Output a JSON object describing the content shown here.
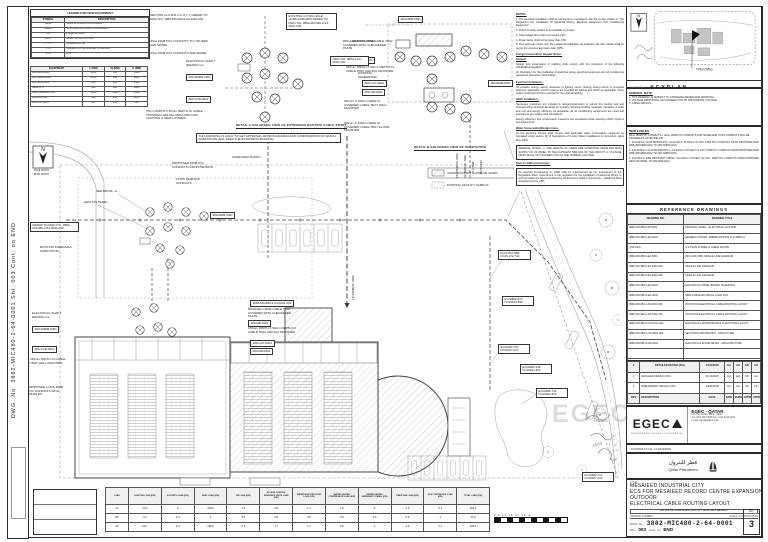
{
  "frame": {
    "left_strip": "DWG. No. 3882-MIC480-2-64-0001      Sht. 003      Cont. on END"
  },
  "legend": {
    "title": "LEGEND FOR NEW EQUIPMENT",
    "rows": [
      [
        "SYMBOL",
        "DESCRIPTION"
      ],
      [
        "MDB",
        "MAIN DISTRIBUTION BOARD"
      ],
      [
        "SMDB",
        "SUB MAIN DISTRIBUTION BOARD"
      ],
      [
        "PB",
        "PANEL BOARD"
      ],
      [
        "ECO",
        "ELECTRICAL CUT-OUT"
      ],
      [
        "— — —",
        "CABLE ROUTE"
      ],
      [
        "CTC",
        "CABLE ROUTE MARKER STRAIGHT"
      ],
      [
        "ATS",
        "ATS"
      ]
    ]
  },
  "equipment": {
    "rows": [
      [
        "EQUIPMENT",
        "L (MM)",
        "W (MM)",
        "H (MM)"
      ],
      [
        "480-MDB-0001",
        "1250",
        "600",
        "1900"
      ],
      [
        "480-SMDB-0001",
        "1250",
        "600",
        "1900"
      ],
      [
        "480-SDB-0001",
        "800",
        "600",
        "1900"
      ],
      [
        "NEW ATS",
        "800",
        "600",
        "1800"
      ],
      [
        "NEW GENERATOR",
        "3000",
        "1100",
        "1600"
      ],
      [
        "480-DB-0001",
        "600",
        "400",
        "1100"
      ],
      [
        "480-LCP-0001",
        "457",
        "305",
        "610"
      ]
    ]
  },
  "notes": {
    "items": [
      {
        "t": "NOTES:-",
        "u": 1
      },
      {
        "t": "1. The electrical installation shall be carried out in compliance with the current edition of “The Regulation For Installation Of Electrical Wiring, Electrical Equipment And Conditioning Equipment”."
      },
      {
        "t": "2. Drawn & cable window to be available by design."
      },
      {
        "t": "3. Total voltage drop shall not exceed 2.5%."
      },
      {
        "t": "4. Power factor shall not be lower than 0.90."
      },
      {
        "t": "5. This approval covers only the notations/modification as indicated. All other details shall be as per the previous approval under QPW.",
        "mb": 3
      },
      {
        "t": "Energy Conservation Regular Notes:-",
        "u": 1
      },
      {
        "t": "General:",
        "u": 1
      },
      {
        "t": "Design and construction of building shall comply with the provisions of the following KAHRAMAA regulation:"
      },
      {
        "t": "(1) Regulation for the installation of electrical wiring, electrical equipment and air conditioning equipment December 2010 edition.",
        "mb": 3
      },
      {
        "t": "Electrical Installation:-",
        "u": 1
      },
      {
        "t": "All possible energy saving measures in lighting sector. Energy saving lamps is proposed wherever applicable; control systems are provided for lighting and HVAC as applicable. Timer and/or photocell control is ensured for the external lighting.",
        "mb": 3
      },
      {
        "t": "HVAC Installation:-",
        "u": 1
      },
      {
        "t": "Necessary provisions are included in design/construction to reduce the cooling load and corresponding electrical demands by properly selecting building materials, insulation to walls and roof and energy efficiency as applicable. All air conditioning equipments are sized and selected as per cooling load calculations."
      },
      {
        "t": "Energy efficiency and conservation measures are considered while selecting HVAC systems and equipments.",
        "mb": 3
      },
      {
        "t": "Water Conservation/Design notes:-",
        "u": 1
      },
      {
        "t": "All the plumbing fixtures shall comply with applicable water conservation measures as stipulated under section (3) of Regulations of Interior Water installations & connection mains May 2005.",
        "mb": 3
      },
      {
        "t": "GENERAL NOTES:-  1- THE LENGTH OF CABLE ARE COMPUTED FROM THE MAIN SUPPLY OF CS PANEL TO THE FARTHEST DB/LOAD OF THE CIRCUIT.  2- VOLTAGE DROP SHALL NOT EXCEED 2.5% OF THE NOMINAL VOLTAGE.",
        "b": 1
      },
      {
        "t": "Note for AMR provisioning:-",
        "u": 1
      },
      {
        "t": "As required provisioning for AMR shall be implemented as per amendment to the Regulation titled “Amendment to the regulation for the installation of Electrical Wiring to accommodate the Advanced Metering Infrastructure (AMI) Components – Additional Field Requirements for AMI”.",
        "b": 1
      }
    ]
  },
  "plan": {
    "labels": [
      {
        "x": 150,
        "y": 14,
        "t": "SECTION (A-A,B-B,C-C & Y-Y) REFER TO DWG NO. 3882-MIC480-2-64-0001-002",
        "w": 62
      },
      {
        "x": 150,
        "y": 40,
        "t": "4Nos 150Ø PVC CONDUITS TO UTILIZED AND SPARE",
        "w": 62
      },
      {
        "x": 150,
        "y": 52,
        "t": "2Nos 150Ø PVC CONDUITS ARE SPARE",
        "w": 62
      },
      {
        "x": 286,
        "y": 13,
        "t": "EXISTING C.P.WH HOLE (1200x1200x600) REFER TO DWG NO. 3882-MIC480-2-64-0001-002",
        "w": 46,
        "b": 1
      },
      {
        "x": 186,
        "y": 60,
        "t": "ELECTRICAL SHAFT 900x600 mm",
        "w": 40
      },
      {
        "x": 186,
        "y": 74,
        "t": "480-SMDB-0001",
        "b": 1
      },
      {
        "x": 186,
        "y": 96,
        "t": "480-CCB-0002",
        "b": 1
      },
      {
        "x": 343,
        "y": 40,
        "t": "800mmX1350mm BCE CABLE TRAY COVERED WITH CHECKERED PLATE",
        "w": 52
      },
      {
        "x": 352,
        "y": 57,
        "t": "480-DB-0001",
        "b": 1
      },
      {
        "x": 346,
        "y": 66,
        "t": "150mm WIDTH X 50mm DEPTH GI CABLE TRAY CEILING MOUNTED",
        "w": 55
      },
      {
        "x": 362,
        "y": 80,
        "t": "480-LCP-0001",
        "b": 1
      },
      {
        "x": 362,
        "y": 89,
        "t": "480-DB-0002",
        "b": 1
      },
      {
        "x": 146,
        "y": 110,
        "t": "75mm WIDTH X 50mm DEPTH GI CABLE TRUNKING CEILING MOUNTED FOR LIGHTING & SMALL POWER",
        "w": 58
      },
      {
        "x": 398,
        "y": 16,
        "t": "480-MDB-0001",
        "b": 1
      },
      {
        "x": 366,
        "y": 24,
        "t": "EXISTING SUBSTATION",
        "light": 1
      },
      {
        "x": 352,
        "y": 40,
        "t": "NEW ATS PANEL"
      },
      {
        "x": 330,
        "y": 56,
        "t": "DWG NO. 3882-2-64-0001-002",
        "w": 34,
        "b": 1
      },
      {
        "x": 358,
        "y": 72,
        "t": "EXISTING GENERATOR",
        "w": 30
      },
      {
        "x": 344,
        "y": 100,
        "t": "300mm X 100mm WIDE GI COVERED CABLE TRAY WALL MOUNTED",
        "w": 46
      },
      {
        "x": 344,
        "y": 122,
        "t": "300mm X 100mm WIDE GI COVERED CABLE TRAY FLOOR MOUNTED",
        "w": 46
      },
      {
        "x": 488,
        "y": 80,
        "t": "480-EDB-0001",
        "b": 1
      },
      {
        "x": 414,
        "y": 146,
        "t": "DETAIL-B ENLARGED VIEW OF SUBSTATION",
        "u": 1
      },
      {
        "x": 236,
        "y": 124,
        "t": "DETAIL-A ENLARGED VIEW OF EXTENSION ROUTING CABLE ENTRY",
        "u": 1
      },
      {
        "x": 196,
        "y": 133,
        "t": "THIS DRAWING IS HOLD TO GET APPROVAL FROM KAHRAMAA AND CONFIRMATION OF WHICH SUBSTATION WILL FEED THE EXTENSION BUILDING",
        "w": 140,
        "b": 1
      },
      {
        "x": 232,
        "y": 156,
        "t": "KAHRAMAA SUPPLY"
      },
      {
        "x": 96,
        "y": 190,
        "t": "SEE DETAIL -A"
      },
      {
        "x": 84,
        "y": 201,
        "t": "NEW ATS PANEL"
      },
      {
        "x": 30,
        "y": 222,
        "t": "REFER TO DWG NO. 3882-MIC480-2-64-0001-002",
        "w": 44,
        "b": 1
      },
      {
        "x": 40,
        "y": 246,
        "t": "EXISTING KAHRAMAA SUBSTATION",
        "w": 36
      },
      {
        "x": 172,
        "y": 162,
        "t": "PROPOSED 100Ø PVC CONDUITS FOR EXTENSION",
        "w": 44
      },
      {
        "x": 176,
        "y": 178,
        "t": "2 NOS 100Ø PVC CONDUITS",
        "w": 34
      },
      {
        "x": 210,
        "y": 212,
        "t": "480-MDB-0001",
        "b": 1
      },
      {
        "x": 250,
        "y": 300,
        "t": "3882-MIC480-2-64-0001-002",
        "b": 1
      },
      {
        "x": 248,
        "y": 308,
        "t": "800x600mm BCE CABLE TRAY COVERED WITH CHECKERED PLATE",
        "w": 50
      },
      {
        "x": 248,
        "y": 320,
        "t": "480-DB-0001",
        "b": 1
      },
      {
        "x": 248,
        "y": 327,
        "t": "150mm WIDTH X 50mm DEPTH GI CABLE TRAY CEILING MOUNTED",
        "w": 52
      },
      {
        "x": 250,
        "y": 340,
        "t": "480-LCP-0001",
        "b": 1
      },
      {
        "x": 250,
        "y": 348,
        "t": "480-DB-0002",
        "b": 1
      },
      {
        "x": 32,
        "y": 312,
        "t": "ELECTRICAL SHAFT 900x600 mm",
        "w": 36
      },
      {
        "x": 32,
        "y": 326,
        "t": "480-SMDB-0001",
        "b": 1
      },
      {
        "x": 32,
        "y": 346,
        "t": "480-CCB-0001",
        "b": 1
      },
      {
        "x": 30,
        "y": 358,
        "t": "150mm WIDTH GI CABLE TRAY WALL MOUNTED",
        "w": 40
      },
      {
        "x": 28,
        "y": 386,
        "t": "PROPOSED 4 NOS 100Ø PVC CONDUITS WITH DRAW PIT",
        "w": 40
      },
      {
        "x": 524,
        "y": 176,
        "t": "E=23359.200 N=26190.820",
        "w": 27,
        "b": 1
      },
      {
        "x": 498,
        "y": 250,
        "t": "E=23,867.988 N=26,172.742",
        "w": 28,
        "b": 1
      },
      {
        "x": 502,
        "y": 296,
        "t": "E=22869.670 N=26216.830",
        "w": 27,
        "b": 1
      },
      {
        "x": 498,
        "y": 344,
        "t": "E=23283.767 N=26017.017",
        "w": 27,
        "b": 1
      },
      {
        "x": 520,
        "y": 364,
        "t": "E=23283.138 N=26231.822",
        "w": 27,
        "b": 1
      },
      {
        "x": 536,
        "y": 388,
        "t": "E=23286.731 N=26031.876",
        "w": 27,
        "b": 1
      },
      {
        "x": 582,
        "y": 472,
        "t": "E=23282.711 N=26007.074",
        "w": 27,
        "b": 1
      },
      {
        "x": 447,
        "y": 172,
        "t": "CONSTRUCTION SCOPE OF WORK"
      },
      {
        "x": 447,
        "y": 184,
        "t": "EXISTING FACILITY CAMPUS"
      },
      {
        "x": 456,
        "y": 178,
        "t": "15x185Ø(4C-70Ø)",
        "r": -90
      },
      {
        "x": 464,
        "y": 178,
        "t": "3x150Ø(4C-70Ø)",
        "r": -90
      },
      {
        "x": 472,
        "y": 172,
        "t": "1x150Ø",
        "r": -90
      },
      {
        "x": 480,
        "y": 174,
        "t": "EXISTING",
        "r": -90
      },
      {
        "x": 352,
        "y": 300,
        "t": "16x185Ø(4C-70Ø)",
        "r": -90
      },
      {
        "x": 34,
        "y": 170,
        "t": "TRUE NORTH",
        "fs": 2.3
      },
      {
        "x": 34,
        "y": 174,
        "t": "BLDG NORTH",
        "fs": 2.3
      },
      {
        "x": 592,
        "y": 444,
        "t": "18/12",
        "hw": 1,
        "fs": 4,
        "r": -15
      }
    ]
  },
  "keyplan": {
    "north": "N",
    "this_dwg": "THIS DWG",
    "caption": "KEYPLAN",
    "hw": "4/12/18"
  },
  "general_note": {
    "title": "GENERAL NOTE:",
    "items": [
      {
        "t": "1. THIS DRAWING IS SUBJECT TO KAHRAMAA REVIEW AND APPROVAL."
      },
      {
        "t": "2. VOLTAGE DROP SHALL NOT EXCEED 2.5% OF THE NOMINAL VOLTAGE."
      },
      {
        "t": "3. CABLE DETAILS:-"
      }
    ]
  },
  "new_cables": {
    "title": "NEW CABLES",
    "intro": "4Nos 150Ø PVC CONDUITS + 2Nos 150Ø PVC CONDUITS FOR SPARE AND THICK CONDUITS WILL BE UTILIZED AS LISTED BELOW",
    "items": [
      {
        "t": "1.  4Cx240mm² CU/XLPE/SWA/PVC +1Cx120mm² PVC/ECC IN 1NO. 150Ø PVC CONDUITS FROM PROPOSED NEW MDB (480-MDB-0001) TO (480-SMDB-0001)."
      },
      {
        "t": "2.  2(3Cx240mm² AL/XLPE/SWA/PVC) +1Cx240mm² PVC/ECC IN 2NO. 150Ø PVC CONDUITS FROM PROPOSED NEW MDB (480-MDB-0001) TO (480-SMDB-0002)."
      },
      {
        "t": "3.  4Cx240mm² FIRE RESISTANT CABLE +1Cx120mm² PVC/ECC IN 1NO. 150Ø PVC CONDUITS FROM PROPOSED NEW ATS PANEL TO (480-SDB-0001)."
      }
    ]
  },
  "reference_drawings": {
    "title": "REFERENCE DRAWINGS",
    "rows": [
      [
        "DRAWING NO.",
        "DRAWING TITLE"
      ],
      [
        "3882-MIC480-0-00-0001",
        "DRAWING INDEX - ELECTRICAL SYSTEM"
      ],
      [
        "3882-MIC480-0-EA-0001",
        "GENERAL NOTES, ABBREVIATIONS & SYMBOLS"
      ],
      [
        "(765-A00)",
        "S.S PLAN-POWER & CABLE ROUTE"
      ],
      [
        "3882-MIC480-9-EJ-0001",
        "(MIC-400)-0001 SINGLE LINE DIAGRAM"
      ],
      [
        "3882-MIC480-9-EJ-0002-001",
        "SINGLE LINE DIAGRAM"
      ],
      [
        "3882-MIC480-9-EJ-0002-002",
        "SINGLE LINE DIAGRAM"
      ],
      [
        "3882-MIC480-9-EA-0001",
        "ELECTRICAL PANEL BOARD SCHEDULE"
      ],
      [
        "3882-MIC480-9-EA-0002",
        "MDB-A DB ELECTRICAL LOAD LIST"
      ],
      [
        "3882-MIC480-2-64-0001-001",
        "OUTDOOR ELECTRICAL CABLE ROUTING LAYOUT"
      ],
      [
        "3882-MIC480-2-64-0001-002",
        "OUTDOOR ELECTRICAL CABLE ROUTING LAYOUT"
      ],
      [
        "3882-MIC480-9-CD-0012-002",
        "ELECTRICAL ROOM DETAILS & SECTIONS LAYOUT"
      ],
      [
        "3882-MIC480-9-CP-0001-004",
        "SECTIONS AND DETAILS - STRUCTURE"
      ],
      [
        "3882-MIC480-9-AD-0001",
        "ELECTRICAL ROOM DETAIL - ARCHITECTURE"
      ],
      [
        "",
        ""
      ],
      [
        "",
        ""
      ],
      [
        "",
        ""
      ]
    ]
  },
  "revisions": {
    "rows": [
      [
        "2",
        "DETAILED DESIGN (IFA)",
        "17/12/2018",
        "AH",
        "AH",
        "KN",
        "AH"
      ],
      [
        "1",
        "DETAILED DESIGN (IFC)",
        "01/11/2018",
        "AH",
        "AH",
        "KN",
        "AH"
      ],
      [
        "0",
        "PRELIMINARY DESIGN (IFC)",
        "24/09/2018",
        "AH",
        "AH",
        "KN",
        "LD"
      ],
      [
        "REV",
        "DESCRIPTION",
        "DATE",
        "DRN",
        "CHKD",
        "APPD",
        "APPD"
      ]
    ]
  },
  "logos": {
    "watermark": "EGEC",
    "consultant": "EGEC",
    "consultant_sub": "ENGINEERING HOUSE OF EXPERTISE",
    "qatar": "EGEC - QATAR",
    "addr1": "P.O. Box 24149, Doha - Qatar",
    "addr2": "Tel: +974 4443 6666  Fax: +974 4443 2181",
    "addr3": "e-mail: egec@qatar.net.qa",
    "contract": "CONTRACT No. LC19194900"
  },
  "client": {
    "arabic": "قطر للبترول",
    "english": "Qatar Petroleum"
  },
  "title_block": {
    "label": "TITLE",
    "line1": "MESAIEED INDUSTRIAL CITY",
    "line2": "ECS FOR MESAIEED RECORD CENTRE EXPANSION",
    "line3": "OUTDOOR",
    "line4": "ELECTRICAL CABLE ROUTING LAYOUT",
    "cad_note": "THIS IS A CAD DRAWING AND MUST NOT BE ALTERED MANUALLY",
    "scale_label": "DRAWING NUMBER",
    "scale_value": "SCALE: AS SHOWN @ A0",
    "dwg_label": "DWG. No.",
    "dwg_no": "3882-MIC480-2-64-0001",
    "rev_label": "REV.",
    "rev": "3",
    "sht_label": "Sht.",
    "sht": "003",
    "cont_label": "Cont. on",
    "cont": "END"
  },
  "load_table": {
    "rows": [
      [
        "LOAD",
        "LIGHTING LOAD (KW)",
        "SOCKETS LOAD (KW)",
        "HVAC LOAD (KW)",
        "DB LOAD (KW)",
        "ACCESS CONTROL INTERFACE UNITS LOAD (KW)",
        "WATER BOOSTER PUMP LOAD (KW)",
        "WATER HEATER COMPRESSOR LOAD (KW)",
        "WATER HEATER EMERGENCY PANEL (KW)",
        "TIMER FAN LOAD (KW)",
        "UPS CONTINUOUS LOAD (KW)",
        "TOTAL LOAD (KW)"
      ],
      [
        "CL",
        "23.5",
        "9",
        "150.0",
        "1.6",
        "2.8",
        "1.1",
        "7.5",
        "5",
        "1.5",
        "5.1",
        "203.3"
      ],
      [
        "DF",
        "3.4",
        "3.4",
        "1",
        "5.5",
        "5.8",
        "0.8",
        "0.8",
        "0.6",
        "0.6",
        "1",
        "21.9"
      ],
      [
        "DL",
        "26.7",
        "6.4",
        "155.0",
        "5.5",
        "1.7",
        "0.7",
        "6.8",
        "2",
        "4.5",
        "5.1",
        "230.4"
      ]
    ]
  },
  "scalebar": {
    "labels": "0    5    10    15    20    25 m"
  }
}
